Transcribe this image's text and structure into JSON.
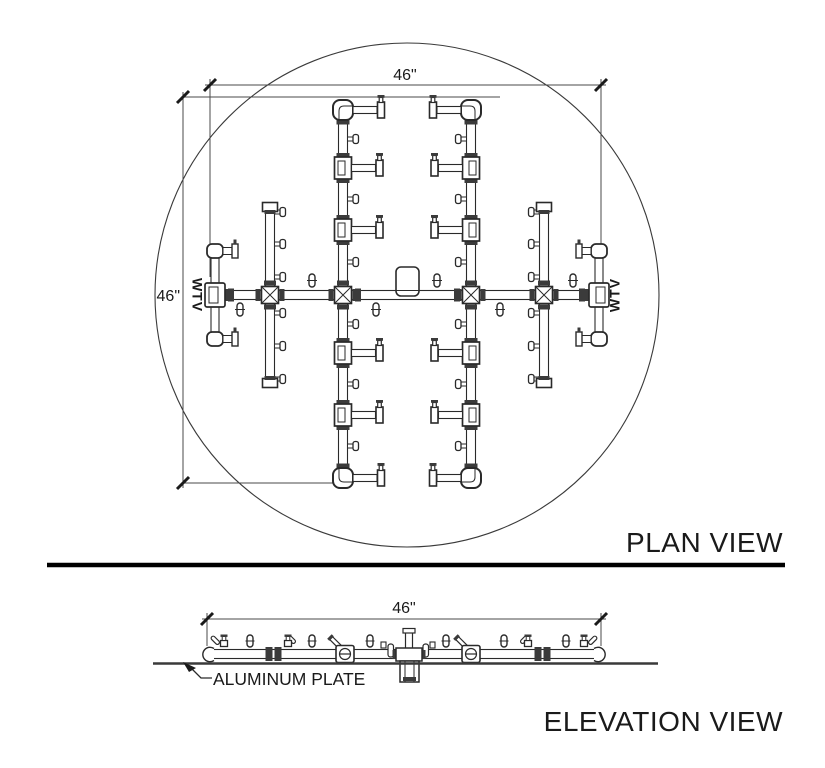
{
  "drawing": {
    "plan_view": {
      "title": "PLAN VIEW",
      "dim_width": "46\"",
      "dim_height": "46\"",
      "marking_left": "WTV",
      "marking_right": "WTV"
    },
    "elevation_view": {
      "title": "ELEVATION VIEW",
      "dim_width": "46\"",
      "plate_label": "ALUMINUM PLATE"
    },
    "colors": {
      "background": "#ffffff",
      "line": "#2a2a2a",
      "dim_line": "#4a4a4a",
      "dark_fill": "#3b3b3b",
      "text": "#1a1a1a"
    }
  }
}
